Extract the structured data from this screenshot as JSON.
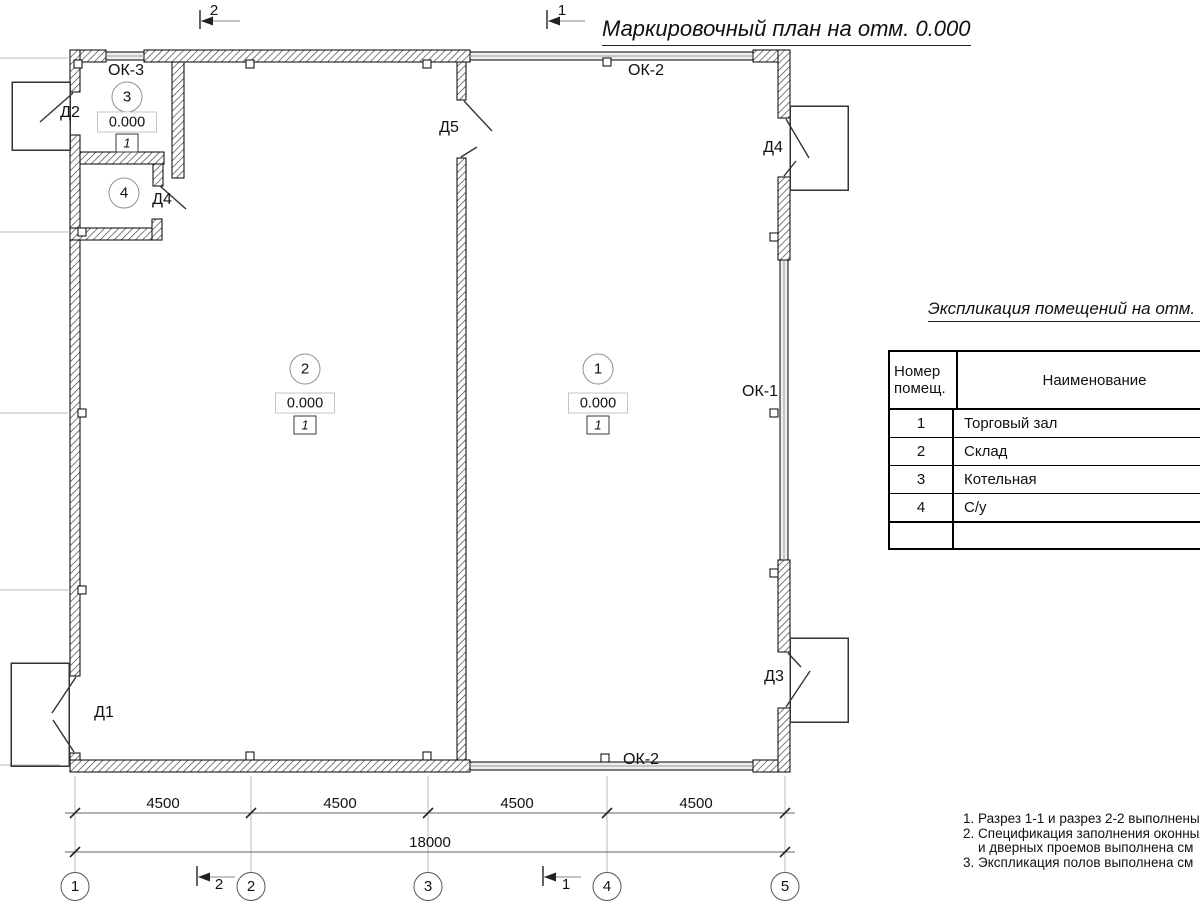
{
  "title": "Маркировочный план на отм. 0.000",
  "rooms": {
    "r1": {
      "number": "1",
      "elevation": "0.000",
      "floor": "1"
    },
    "r2": {
      "number": "2",
      "elevation": "0.000",
      "floor": "1"
    },
    "r3": {
      "number": "3",
      "elevation": "0.000",
      "floor": "1"
    },
    "r4": {
      "number": "4"
    }
  },
  "doors": {
    "d1": "Д1",
    "d2": "Д2",
    "d3": "Д3",
    "d4": "Д4",
    "d4_wc": "Д4",
    "d5": "Д5"
  },
  "windows": {
    "ok1": "ОК-1",
    "ok2": "ОК-2",
    "ok3": "ОК-3"
  },
  "section_marks": {
    "s1": "1",
    "s2": "2"
  },
  "dimensions": {
    "spans": [
      "4500",
      "4500",
      "4500",
      "4500"
    ],
    "total": "18000"
  },
  "axes": [
    "1",
    "2",
    "3",
    "4",
    "5"
  ],
  "legend_table": {
    "title": "Экспликация помещений на отм. 0.000",
    "col1_header": "Номер помещ.",
    "col2_header": "Наименование",
    "rows": [
      {
        "num": "1",
        "name": "Торговый зал"
      },
      {
        "num": "2",
        "name": "Склад"
      },
      {
        "num": "3",
        "name": "Котельная"
      },
      {
        "num": "4",
        "name": "С/у"
      }
    ]
  },
  "notes": [
    "1. Разрез 1-1 и разрез 2-2 выполнены",
    "2. Спецификация заполнения оконных",
    "и дверных проемов выполнена см",
    "3. Экспликация полов выполнена см"
  ]
}
